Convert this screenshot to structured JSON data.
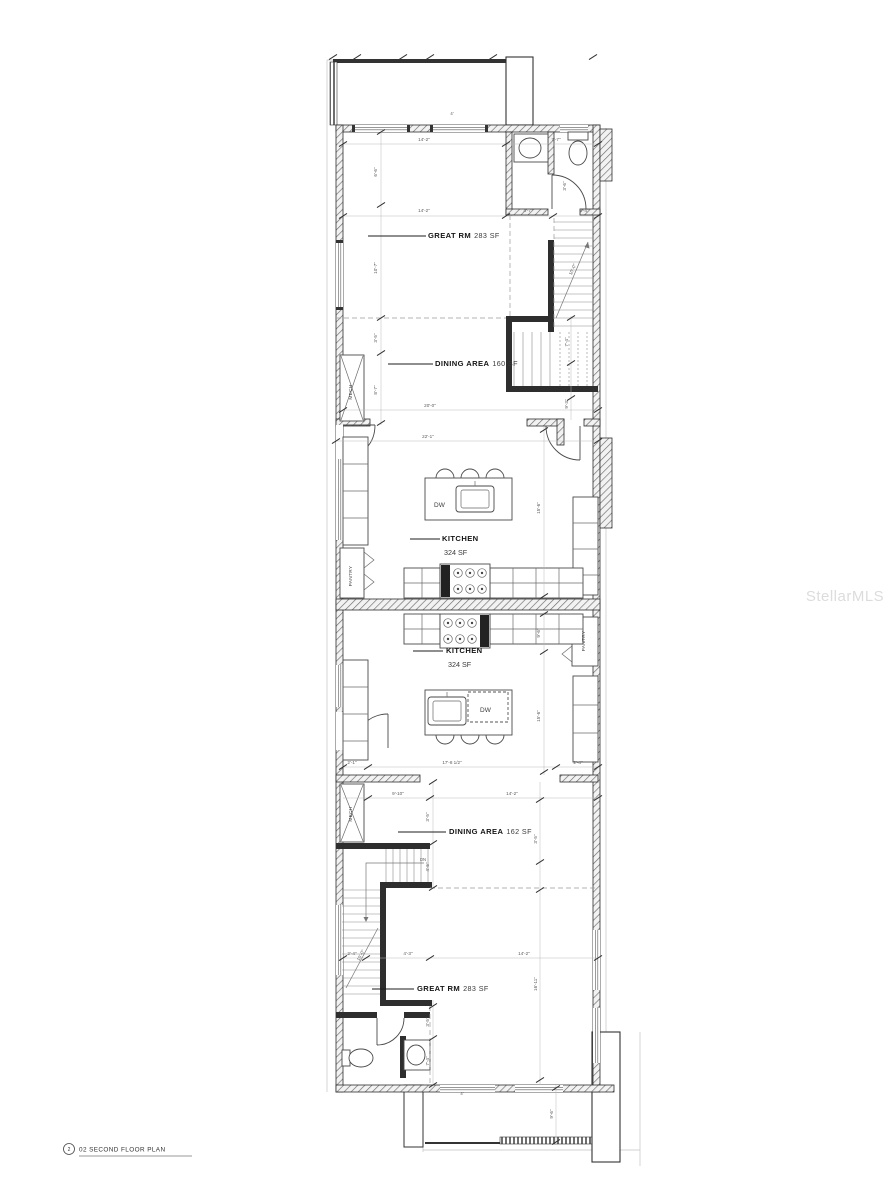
{
  "drawing": {
    "title": {
      "number": "2",
      "text": "02 SECOND FLOOR PLAN"
    },
    "watermark": "StellarMLS"
  },
  "unit_a": {
    "great_rm": {
      "name": "GREAT RM",
      "area": "283 SF"
    },
    "dining": {
      "name": "DINING AREA",
      "area": "160 SF"
    },
    "kitchen": {
      "name": "KITCHEN",
      "area": "324 SF"
    },
    "mech": "MECH",
    "pantry": "PANTRY",
    "dw": "DW",
    "dims": [
      "14'-2\"",
      "7'-7\"",
      "6'-6\"",
      "14'-2\"",
      "4'-7\"",
      "2'-4\"",
      "10'-7\"",
      "10'-0\"",
      "3'-5\"",
      "8'-7\"",
      "7'-4\"",
      "9'-3\"",
      "3'-6\"",
      "20'-0\"",
      "22'-1\"",
      "15'-6\"",
      "4'"
    ]
  },
  "unit_b": {
    "kitchen": {
      "name": "KITCHEN",
      "area": "324 SF"
    },
    "dining": {
      "name": "DINING AREA",
      "area": "162 SF"
    },
    "great_rm": {
      "name": "GREAT RM",
      "area": "283 SF"
    },
    "mech": "MECH",
    "pantry": "PANTRY",
    "dw": "DW",
    "dn": "DN",
    "dims": [
      "9'-6\"",
      "15'-6\"",
      "2'-1\"",
      "17'-8 1/2\"",
      "2'-4\"",
      "9'-10\"",
      "14'-2\"",
      "3'-5\"",
      "3'-5\"",
      "4'-5\"",
      "10'-0\"",
      "2'-4\"",
      "4'-3\"",
      "14'-2\"",
      "16'-11\"",
      "3'-5\"",
      "7'-4\"",
      "9'-6\"",
      "4'"
    ]
  }
}
